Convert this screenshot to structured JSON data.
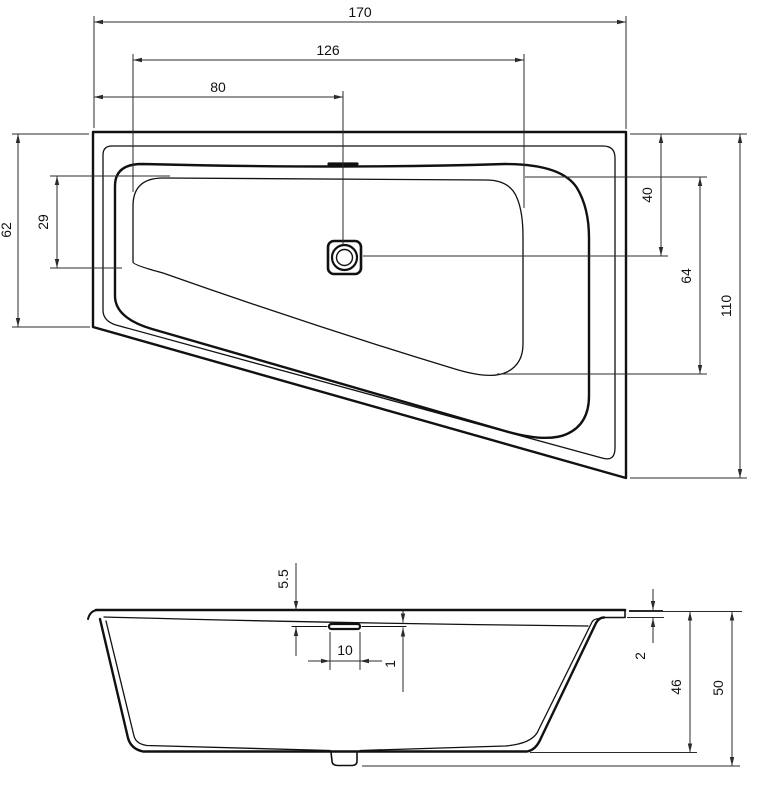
{
  "drawing": {
    "subject": "bathtub-technical-drawing",
    "colors": {
      "background": "#ffffff",
      "outline": "#111111",
      "dimension_lines": "#2b2b2b",
      "text": "#111111"
    },
    "dims": {
      "overall_length": "170",
      "basin_length": "126",
      "drain_from_left": "80",
      "left_side_width": "62",
      "basin_left_inset": "29",
      "drain_from_top": "40",
      "basin_right_length": "64",
      "right_side_width": "110",
      "grip_recess_depth": "5.5",
      "grip_length": "10",
      "grip_line_offset": "1",
      "rim_edge_height": "2",
      "inner_depth": "46",
      "overall_height": "50"
    }
  }
}
